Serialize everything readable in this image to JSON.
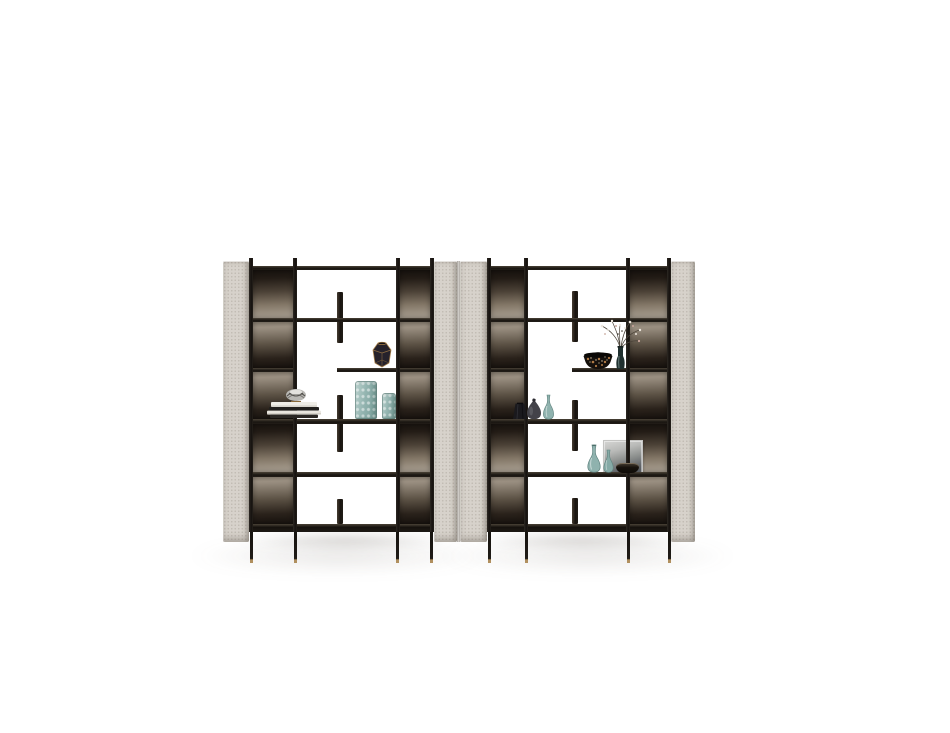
{
  "image": {
    "type": "studio product photo",
    "subject": "Two mirrored freestanding bookshelf modules with upholstered side panels, black metal frame, smoked-bronze back panels, thin legs with brass feet, and decorative objects",
    "background_color": "#ffffff"
  },
  "palette": {
    "bg": "#ffffff",
    "panel": "#d7d2cb",
    "frame_dark": "#16120f",
    "shelf_highlight": "#4a4237",
    "brass_foot": "#b08f5e",
    "teal_glass": "#93b4b0",
    "teal_glass_deep": "#6f958f",
    "art_light": "#d6d6d4",
    "art_dark": "#4f5256",
    "leopard_base": "#15100c",
    "leopard_spot": "#b07a45",
    "book_white": "#efede7",
    "book_black": "#22201e",
    "silver": "#b9b8b4",
    "gold_edge": "#ab8248",
    "charcoal_vase": "#1a191d",
    "smoke_vase": "#434249",
    "dark_glass": "#20302f",
    "branch": "#4a4238",
    "blossom_white": "#ece6dd",
    "blossom_pink": "#c9a79c"
  },
  "units": [
    {
      "id": "left-module",
      "rows": 5,
      "decor": [
        "silver sculpture on stacked books",
        "black faceted vase with gold edges",
        "two teal hobnail glass vases"
      ]
    },
    {
      "id": "right-module",
      "rows": 5,
      "decor": [
        "leopard-pattern bowl",
        "dark glass vase with dried blossom branches",
        "charcoal faceted vase",
        "smoke-gray round vase",
        "teal gourd vase",
        "two teal gourd vases with framed monochrome artwork",
        "small dark bowl"
      ]
    }
  ]
}
